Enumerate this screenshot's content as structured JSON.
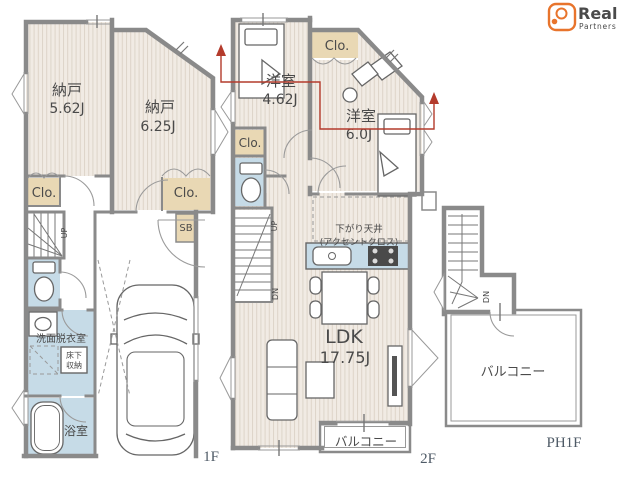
{
  "brand": {
    "name": "Real",
    "tagline": "Partners"
  },
  "floors": {
    "first": "1F",
    "second": "2F",
    "penthouse": "PH1F"
  },
  "rooms": {
    "storage1": {
      "name": "納戸",
      "area": "5.62J"
    },
    "storage2": {
      "name": "納戸",
      "area": "6.25J"
    },
    "western1": {
      "name": "洋室",
      "area": "4.62J"
    },
    "western2": {
      "name": "洋室",
      "area": "6.0J"
    },
    "ldk": {
      "name": "LDK",
      "area": "17.75J"
    },
    "washroom": "洗面脱衣室",
    "bathroom": "浴室",
    "underfloor1": "床下",
    "underfloor2": "収納",
    "balcony": "バルコニー"
  },
  "labels": {
    "closet": "Clo.",
    "shoe_box": "SB",
    "up": "UP",
    "down": "DN",
    "dropped_ceiling": "下がり天井",
    "accent_cross": "(アクセントクロス)"
  },
  "colors": {
    "wall": "#8a8a8a",
    "closet_fill": "#e9d8b4",
    "wet_area_fill": "#c6dbe7",
    "floor_fill": "#f1ebe4",
    "section_line": "#b43b2c",
    "brand_orange": "#e8742c",
    "text": "#4a4a4a",
    "floor_label": "#4e5a66"
  }
}
